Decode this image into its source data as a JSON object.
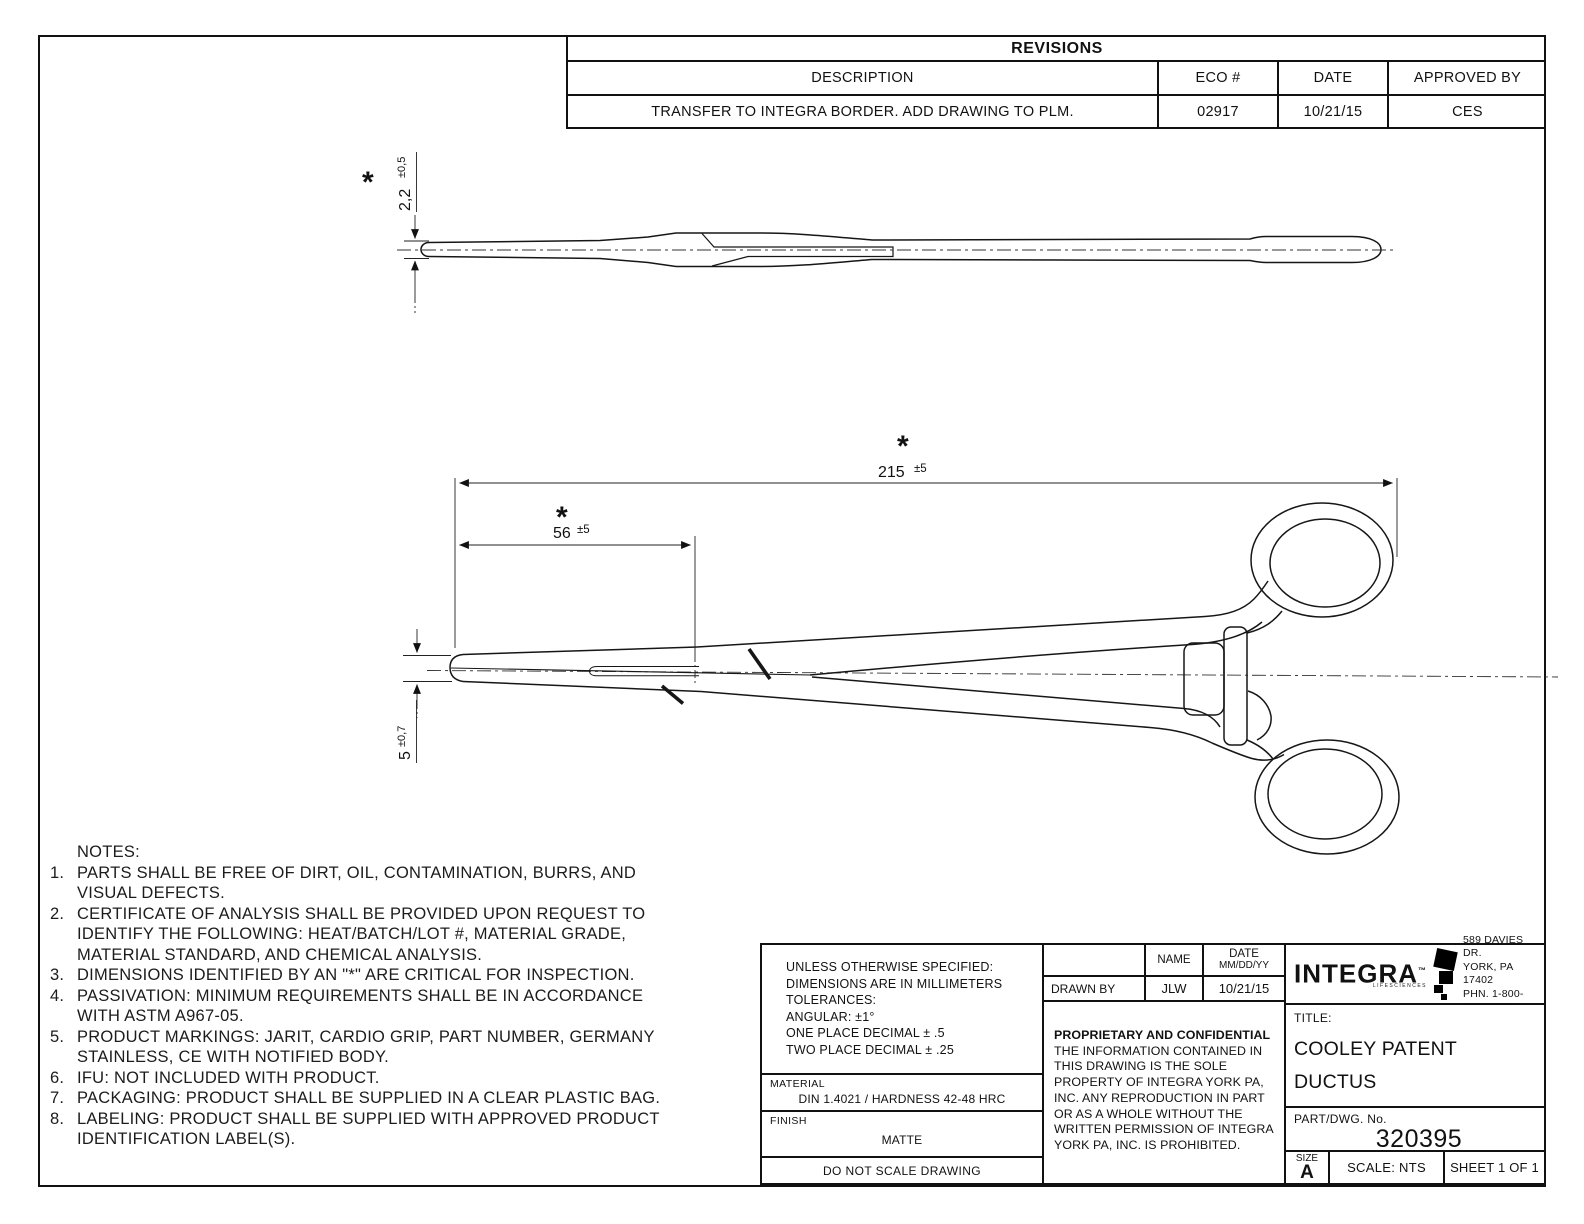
{
  "revisions": {
    "title": "REVISIONS",
    "columns": [
      "DESCRIPTION",
      "ECO #",
      "DATE",
      "APPROVED BY"
    ],
    "rows": [
      [
        "TRANSFER TO INTEGRA BORDER. ADD DRAWING TO PLM.",
        "02917",
        "10/21/15",
        "CES"
      ]
    ]
  },
  "dims": {
    "star": "*",
    "thickness_value": "2,2",
    "thickness_tol": "±0,5",
    "overall_value": "215",
    "overall_tol": "±5",
    "jaw_length_value": "56",
    "jaw_length_tol": "±5",
    "jaw_width_value": "5",
    "jaw_width_tol": "±0,7"
  },
  "notes": {
    "lines": [
      {
        "n": "",
        "t": "NOTES:"
      },
      {
        "n": "1.",
        "t": "PARTS SHALL BE FREE OF DIRT, OIL, CONTAMINATION, BURRS, AND"
      },
      {
        "n": "",
        "t": "VISUAL DEFECTS."
      },
      {
        "n": "2.",
        "t": "CERTIFICATE OF ANALYSIS SHALL BE PROVIDED UPON REQUEST TO"
      },
      {
        "n": "",
        "t": "IDENTIFY THE FOLLOWING: HEAT/BATCH/LOT #, MATERIAL GRADE,"
      },
      {
        "n": "",
        "t": "MATERIAL STANDARD, AND CHEMICAL ANALYSIS."
      },
      {
        "n": "3.",
        "t": "DIMENSIONS IDENTIFIED BY AN \"*\" ARE CRITICAL FOR INSPECTION."
      },
      {
        "n": "4.",
        "t": "PASSIVATION: MINIMUM REQUIREMENTS SHALL BE IN ACCORDANCE"
      },
      {
        "n": "",
        "t": "WITH ASTM A967-05."
      },
      {
        "n": "5.",
        "t": "PRODUCT MARKINGS: JARIT, CARDIO GRIP, PART NUMBER, GERMANY"
      },
      {
        "n": "",
        "t": "STAINLESS, CE WITH NOTIFIED BODY."
      },
      {
        "n": "6.",
        "t": "IFU: NOT INCLUDED WITH PRODUCT."
      },
      {
        "n": "7.",
        "t": "PACKAGING: PRODUCT SHALL BE SUPPLIED IN A CLEAR PLASTIC BAG."
      },
      {
        "n": "8.",
        "t": "LABELING: PRODUCT SHALL BE SUPPLIED WITH APPROVED PRODUCT"
      },
      {
        "n": "",
        "t": "IDENTIFICATION LABEL(S)."
      }
    ]
  },
  "title_block": {
    "tolerance_lines": [
      "UNLESS OTHERWISE SPECIFIED:",
      "DIMENSIONS ARE IN MILLIMETERS",
      "TOLERANCES:",
      "ANGULAR: ±1°",
      "ONE PLACE DECIMAL ± .5",
      "TWO PLACE DECIMAL ± .25"
    ],
    "material_label": "MATERIAL",
    "material_value": "DIN 1.4021 / HARDNESS 42-48 HRC",
    "finish_label": "FINISH",
    "finish_value": "MATTE",
    "do_not_scale": "DO NOT SCALE DRAWING",
    "sign": {
      "name_header": "NAME",
      "date_header": "DATE",
      "date_format": "MM/DD/YY",
      "drawn_by_label": "DRAWN BY",
      "drawn_by_name": "JLW",
      "drawn_by_date": "10/21/15"
    },
    "proprietary_heading": "PROPRIETARY AND CONFIDENTIAL",
    "proprietary_lines": [
      "THE INFORMATION CONTAINED IN",
      "THIS DRAWING IS THE SOLE",
      "PROPERTY OF INTEGRA YORK PA,",
      "INC.  ANY REPRODUCTION IN PART",
      "OR AS A WHOLE WITHOUT THE",
      "WRITTEN PERMISSION OF INTEGRA",
      "YORK PA, INC. IS PROHIBITED."
    ],
    "company": {
      "logo_text": "INTEGRA",
      "logo_tm": "™",
      "tagline": "LIFESCIENCES",
      "address_lines": [
        "589 DAVIES DR.",
        "YORK, PA 17402",
        "PHN. 1-800-645-8000"
      ]
    },
    "title_label": "TITLE:",
    "title_lines": [
      "COOLEY PATENT DUCTUS",
      "CLAMP, 8-1/2\", STRAIGHT"
    ],
    "part_label": "PART/DWG. No.",
    "part_number": "320395",
    "size_label": "SIZE",
    "size_value": "A",
    "scale": "SCALE: NTS",
    "sheet": "SHEET 1 OF 1"
  }
}
